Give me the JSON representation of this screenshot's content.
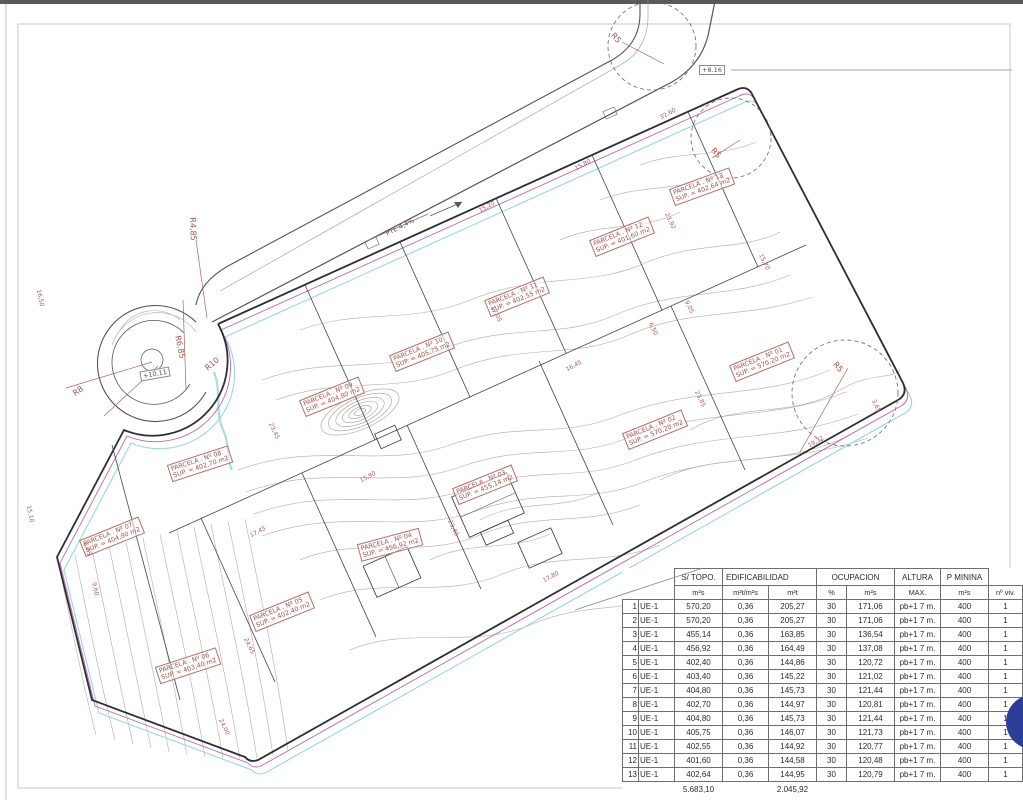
{
  "parcels": [
    {
      "name": "PARCELA . Nº 01",
      "sup": "SUP. = 570,20 m2"
    },
    {
      "name": "PARCELA . Nº 02",
      "sup": "SUP. = 570,20 m2"
    },
    {
      "name": "PARCELA . Nº 03",
      "sup": "SUP. = 455,14 m2"
    },
    {
      "name": "PARCELA . Nº 04",
      "sup": "SUP. = 456,92 m2"
    },
    {
      "name": "PARCELA . Nº 05",
      "sup": "SUP. = 402,40 m2"
    },
    {
      "name": "PARCELA . Nº 06",
      "sup": "SUP. = 403,40 m2"
    },
    {
      "name": "PARCELA . Nº 07",
      "sup": "SUP. = 404,80 m2"
    },
    {
      "name": "PARCELA . Nº 08",
      "sup": "SUP. = 402,70 m2"
    },
    {
      "name": "PARCELA . Nº 09",
      "sup": "SUP. = 404,80 m2"
    },
    {
      "name": "PARCELA . Nº 10",
      "sup": "SUP. = 405,75 m2"
    },
    {
      "name": "PARCELA . Nº 11",
      "sup": "SUP. = 402,55 m2"
    },
    {
      "name": "PARCELA . Nº 12",
      "sup": "SUP. = 401,60 m2"
    },
    {
      "name": "PARCELA . Nº 13",
      "sup": "SUP. = 402,64 m2"
    }
  ],
  "dims": [
    "15,20",
    "15,80",
    "32,60",
    "23,92",
    "15,70",
    "9,05",
    "6,50",
    "16,45",
    "23,85",
    "17,05",
    "23,45",
    "17,45",
    "24,65",
    "15,90",
    "17,80",
    "23,40",
    "19,32",
    "3,65",
    "9,60",
    "6,65",
    "15,10",
    "16,50",
    "24,00"
  ],
  "radii": [
    "R5",
    "R5",
    "R5",
    "R10",
    "R8",
    "R4,85",
    "R6,85"
  ],
  "elevations": {
    "road_top": "+8.16",
    "culdesac": "+10,11"
  },
  "road": {
    "slope_label": "PTE 4,4%"
  },
  "colors": {
    "boundary_magenta": "#b34fae",
    "water_cyan": "#9ed7d8",
    "annotation_red": "#a5524c",
    "blob_blue": "#2e3d96"
  },
  "table": {
    "h1": {
      "s_topo": "S/ TOPO.",
      "edif": "EDIFICABILIDAD",
      "ocup": "OCUPACION",
      "altura": "ALTURA",
      "p_minina": "P MININA"
    },
    "h2": {
      "max": "MAX.",
      "nviv": "nº viv."
    },
    "units": {
      "s_topo": "m²s",
      "ratio": "m²t/m²s",
      "edif_m2": "m²t",
      "pct": "%",
      "ocup_m2": "m²s",
      "p_min_m2": "m²s"
    },
    "rows": [
      [
        "1",
        "UE-1",
        "570,20",
        "0,36",
        "205,27",
        "30",
        "171,06",
        "pb+1 7 m.",
        "400",
        "1"
      ],
      [
        "2",
        "UE-1",
        "570,20",
        "0,36",
        "205,27",
        "30",
        "171,06",
        "pb+1 7 m.",
        "400",
        "1"
      ],
      [
        "3",
        "UE-1",
        "455,14",
        "0,36",
        "163,85",
        "30",
        "136,54",
        "pb+1 7 m.",
        "400",
        "1"
      ],
      [
        "4",
        "UE-1",
        "456,92",
        "0,36",
        "164,49",
        "30",
        "137,08",
        "pb+1 7 m.",
        "400",
        "1"
      ],
      [
        "5",
        "UE-1",
        "402,40",
        "0,36",
        "144,86",
        "30",
        "120,72",
        "pb+1 7 m.",
        "400",
        "1"
      ],
      [
        "6",
        "UE-1",
        "403,40",
        "0,36",
        "145,22",
        "30",
        "121,02",
        "pb+1 7 m.",
        "400",
        "1"
      ],
      [
        "7",
        "UE-1",
        "404,80",
        "0,36",
        "145,73",
        "30",
        "121,44",
        "pb+1 7 m.",
        "400",
        "1"
      ],
      [
        "8",
        "UE-1",
        "402,70",
        "0,36",
        "144,97",
        "30",
        "120,81",
        "pb+1 7 m.",
        "400",
        "1"
      ],
      [
        "9",
        "UE-1",
        "404,80",
        "0,36",
        "145,73",
        "30",
        "121,44",
        "pb+1 7 m.",
        "400",
        "1"
      ],
      [
        "10",
        "UE-1",
        "405,75",
        "0,36",
        "146,07",
        "30",
        "121,73",
        "pb+1 7 m.",
        "400",
        "1"
      ],
      [
        "11",
        "UE-1",
        "402,55",
        "0,36",
        "144,92",
        "30",
        "120,77",
        "pb+1 7 m.",
        "400",
        "1"
      ],
      [
        "12",
        "UE-1",
        "401,60",
        "0,36",
        "144,58",
        "30",
        "120,48",
        "pb+1 7 m.",
        "400",
        "1"
      ],
      [
        "13",
        "UE-1",
        "402,64",
        "0,36",
        "144,95",
        "30",
        "120,79",
        "pb+1 7 m.",
        "400",
        "1"
      ]
    ],
    "totals": {
      "s_topo": "5.683,10",
      "edificabilidad": "2.045,92"
    }
  }
}
